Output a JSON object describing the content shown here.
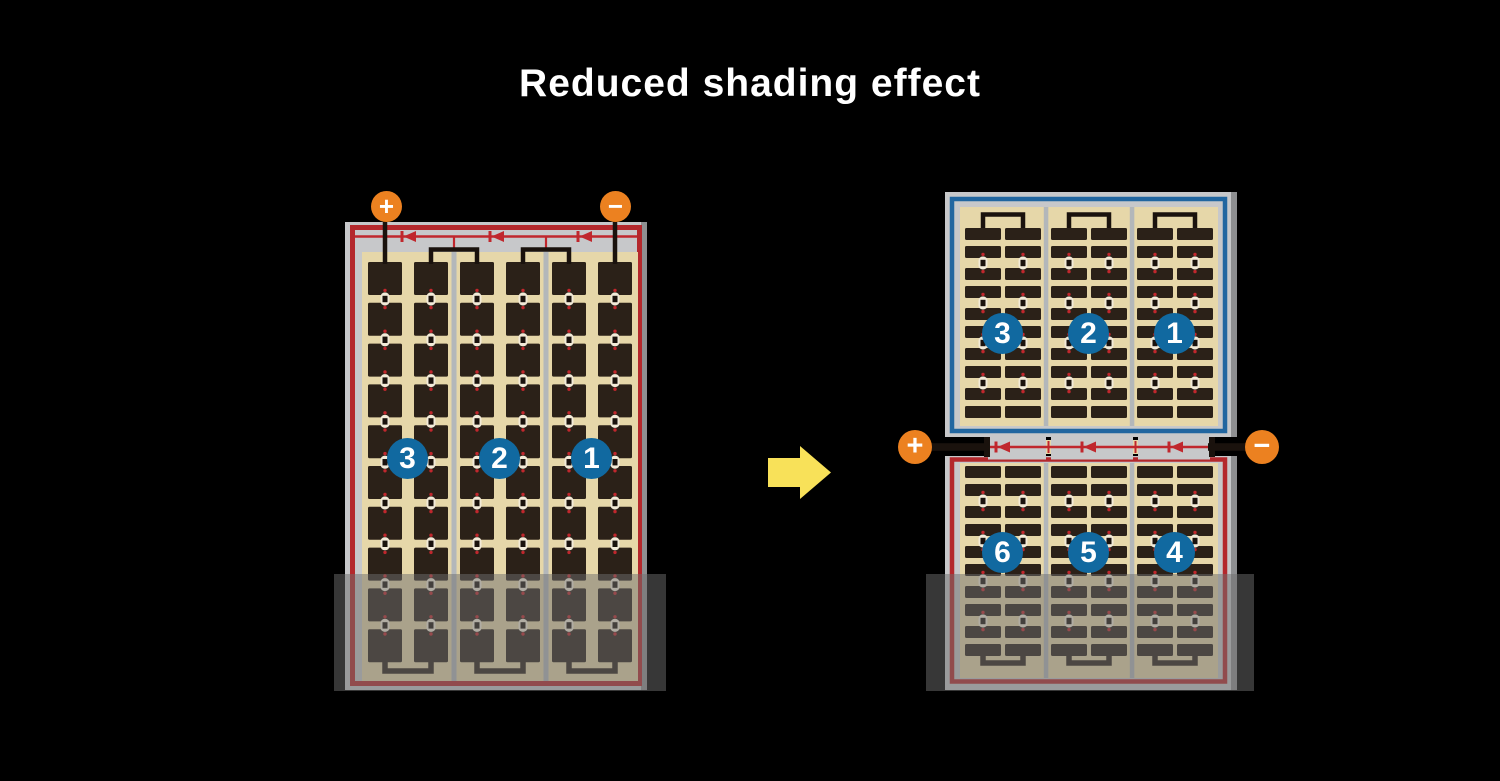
{
  "title": "Reduced shading effect",
  "left_panel": {
    "positive_label": "+",
    "negative_label": "−",
    "string_labels": [
      "3",
      "2",
      "1"
    ]
  },
  "right_panel": {
    "positive_label": "+",
    "negative_label": "−",
    "top_string_labels": [
      "3",
      "2",
      "1"
    ],
    "bottom_string_labels": [
      "6",
      "5",
      "4"
    ]
  },
  "arrow_icon": "right-arrow",
  "colors": {
    "background": "#000000",
    "title_text": "#ffffff",
    "panel_frame": "#c7c8ca",
    "panel_frame_edge": "#8e8f91",
    "red_border": "#b4282c",
    "blue_border": "#2166a0",
    "cell_field": "#e6d7a9",
    "cell_dark": "#2b2118",
    "string_separator": "#b3b7ba",
    "wire_black": "#1a120d",
    "connector_white": "#f2ead8",
    "connector_red": "#c0272d",
    "badge_blue": "#1169a0",
    "badge_text": "#ffffff",
    "terminal_orange": "#ec8120",
    "terminal_text": "#ffffff",
    "arrow_yellow": "#f8e159",
    "shade_overlay": "rgba(110,110,110,0.5)"
  }
}
